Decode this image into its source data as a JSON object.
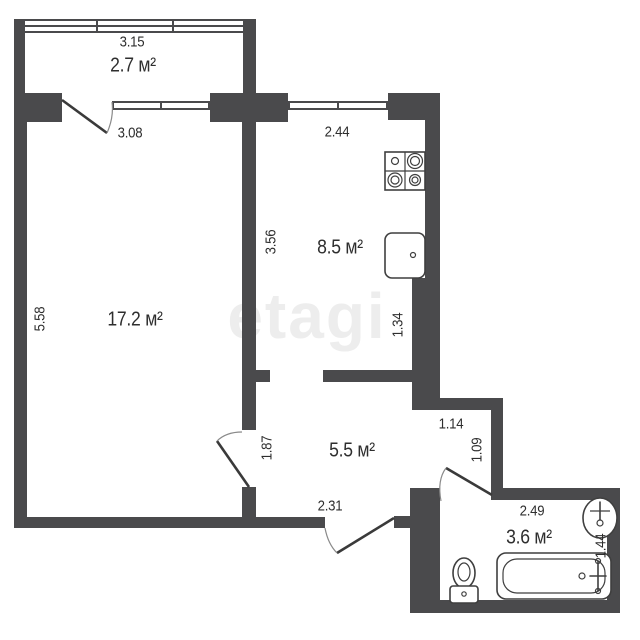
{
  "watermark": "etagi",
  "labels": {
    "balcony_width": "3.15",
    "balcony_area": "2.7 м²",
    "room_width": "3.08",
    "room_height": "5.58",
    "room_area": "17.2 м²",
    "kitchen_width": "2.44",
    "kitchen_height": "3.56",
    "kitchen_area": "8.5 м²",
    "kitchen_niche": "1.34",
    "hall_left": "1.87",
    "hall_area": "5.5 м²",
    "hall_bottom": "2.31",
    "hall_top_right": "1.14",
    "hall_right": "1.09",
    "bath_width": "2.49",
    "bath_area": "3.6 м²",
    "bath_height": "1.44"
  },
  "fixtures": [
    "stove",
    "kitchen-sink",
    "toilet",
    "bathtub",
    "washbasin"
  ],
  "colors": {
    "wall": "#4a4a4c",
    "text": "#2e2e2e",
    "watermark": "#ededed"
  }
}
